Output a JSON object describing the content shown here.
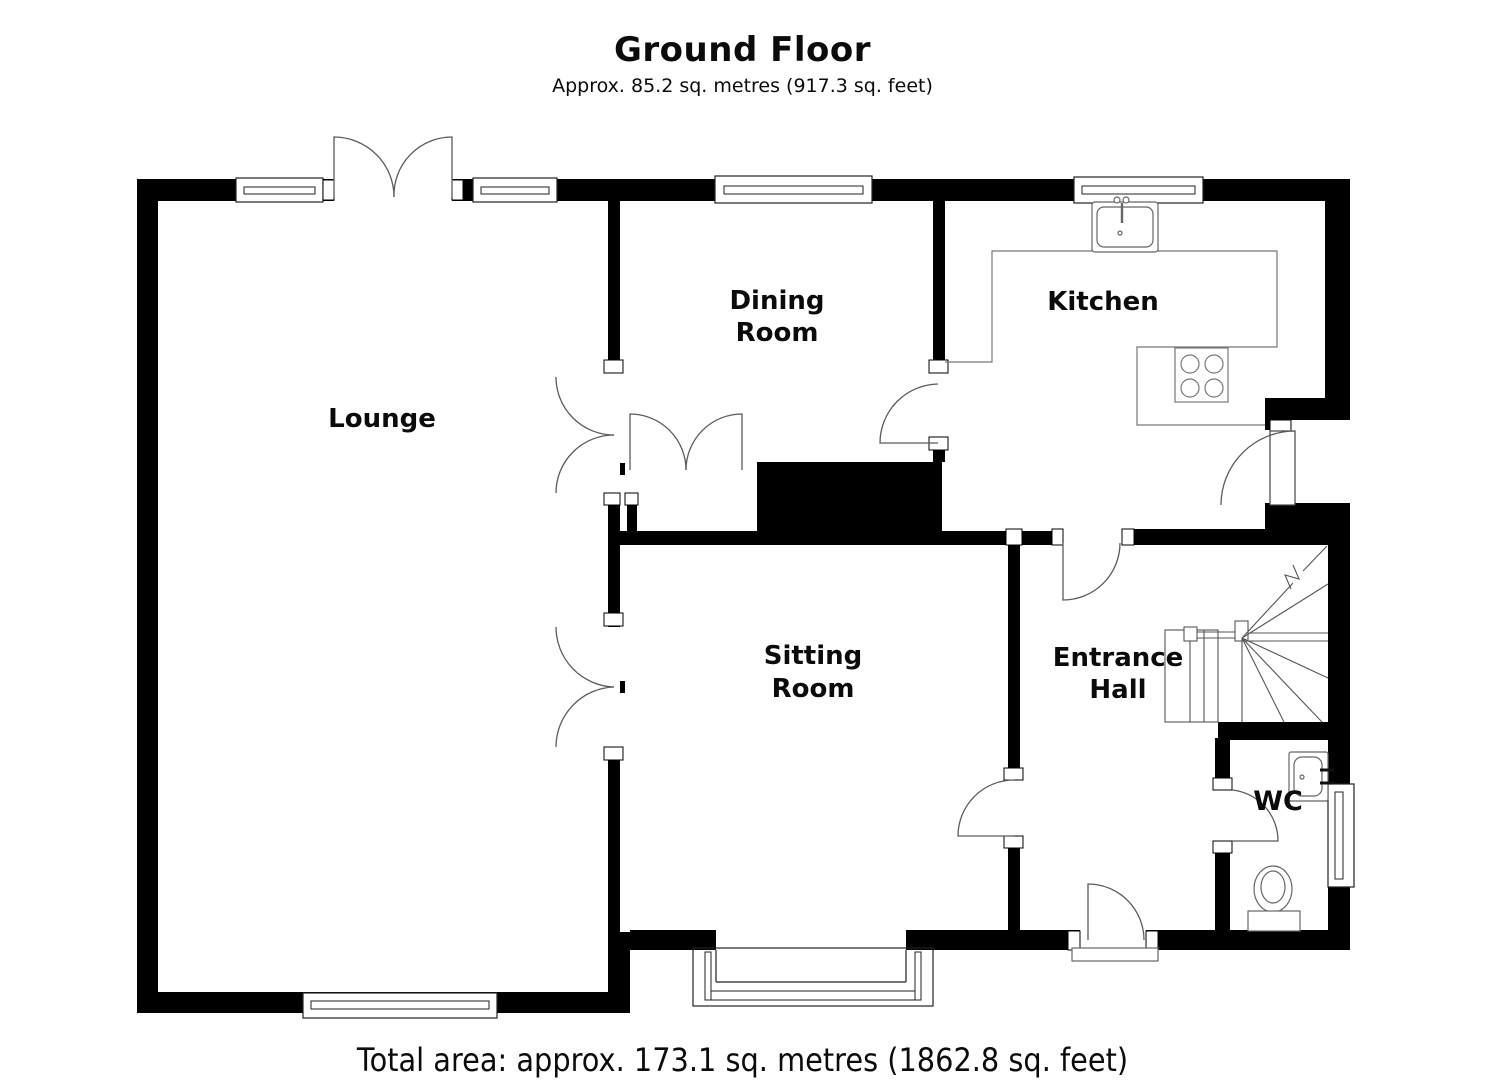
{
  "header": {
    "title": "Ground Floor",
    "subtitle": "Approx. 85.2 sq. metres (917.3 sq. feet)"
  },
  "footer": {
    "total_area": "Total area: approx. 173.1 sq. metres (1862.8 sq. feet)"
  },
  "rooms": {
    "lounge": {
      "label": "Lounge"
    },
    "dining": {
      "line1": "Dining",
      "line2": "Room"
    },
    "kitchen": {
      "label": "Kitchen"
    },
    "sitting": {
      "line1": "Sitting",
      "line2": "Room"
    },
    "hall": {
      "line1": "Entrance",
      "line2": "Hall"
    },
    "wc": {
      "label": "WC"
    }
  },
  "colors": {
    "wall": "#000000",
    "detail_lines": "#5b5b5b",
    "background": "#ffffff"
  }
}
